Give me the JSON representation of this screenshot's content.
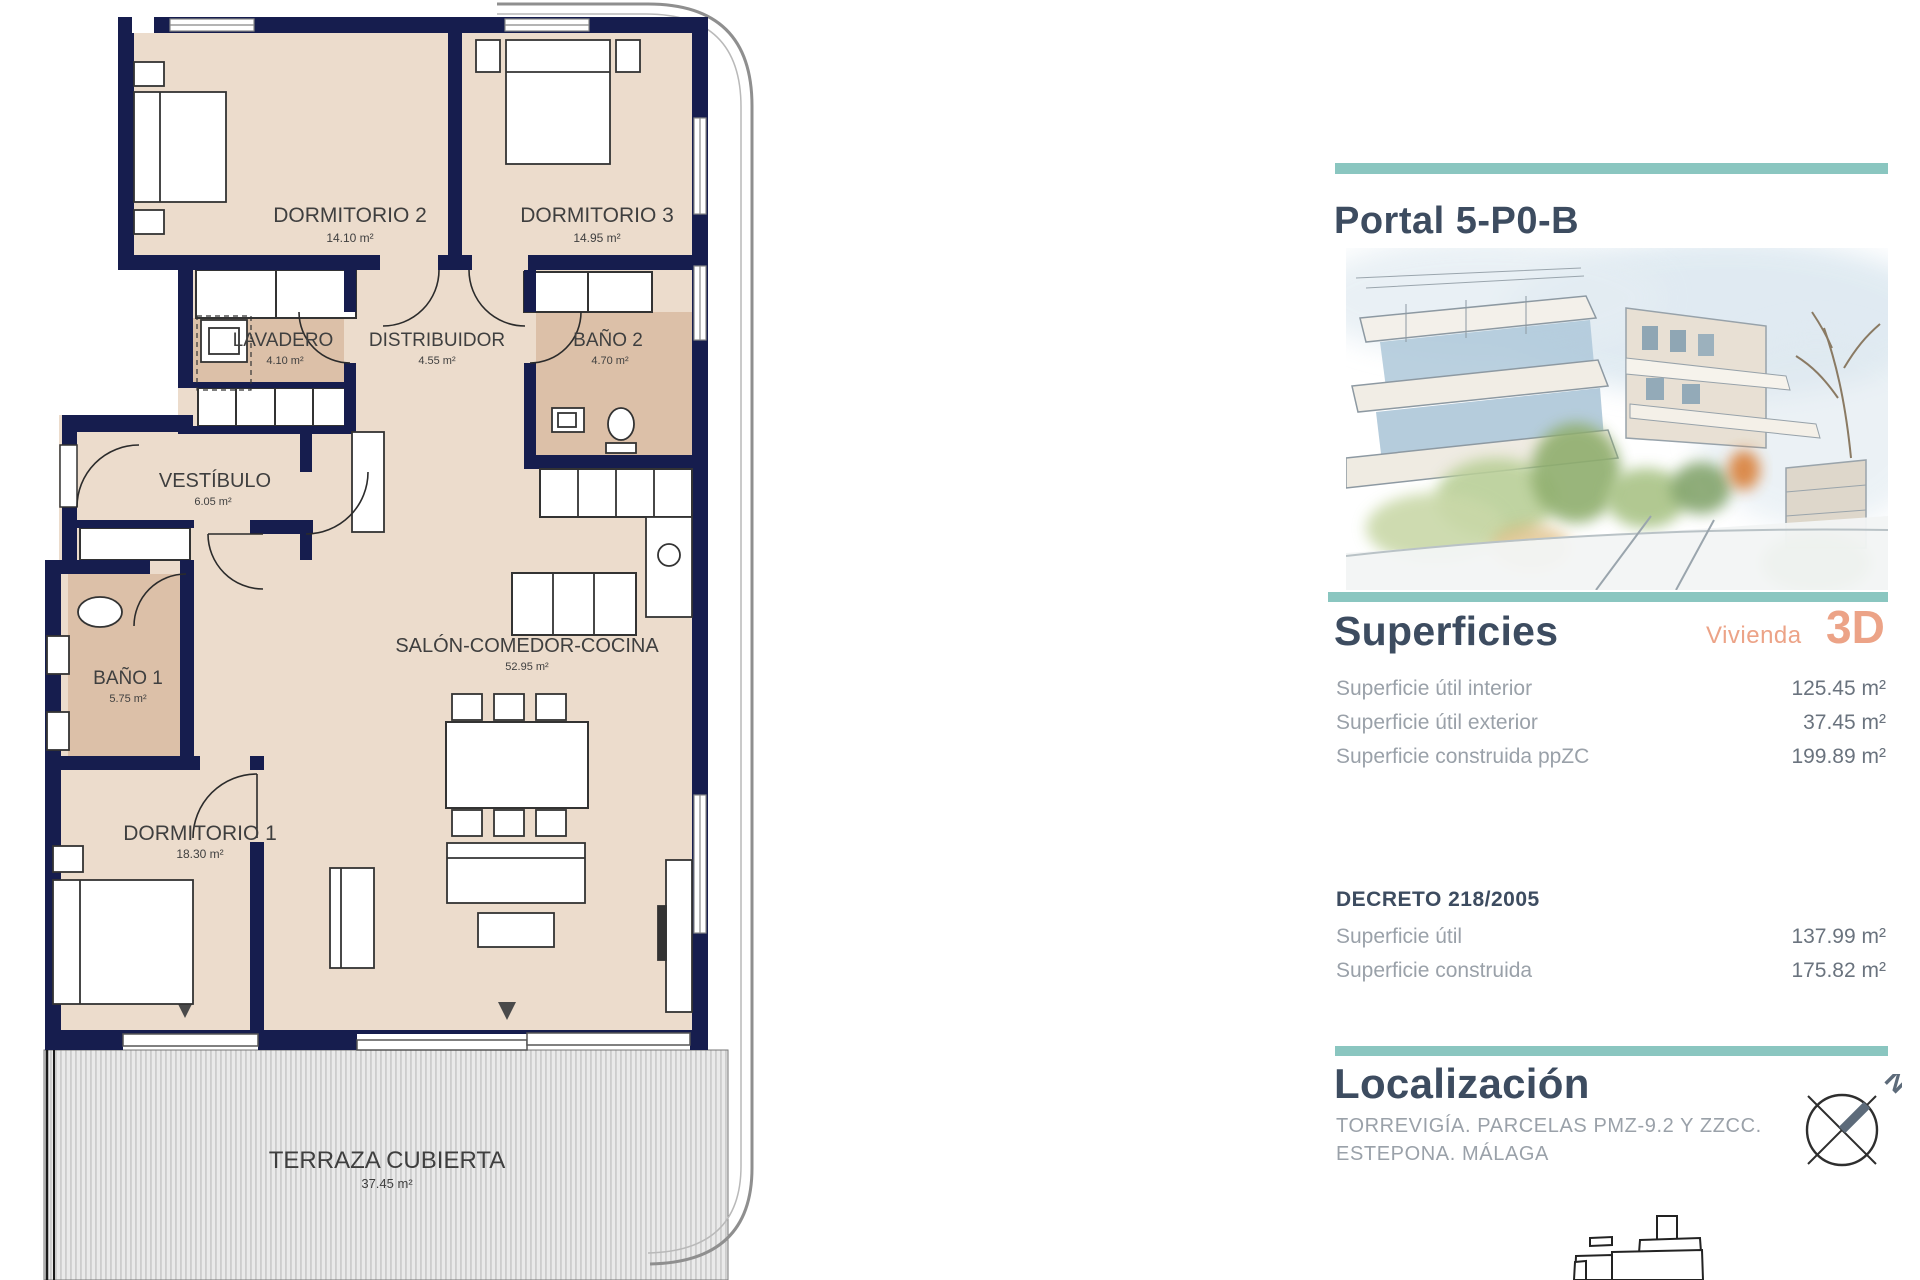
{
  "colors": {
    "wall_navy": "#161d4e",
    "floor_beige": "#ecdccc",
    "wet_tan": "#dcc0a8",
    "accent_teal": "#8ac6c0",
    "heading_slate": "#3d4c60",
    "accent_salmon": "#eca387",
    "label_gray": "#9aa1a9",
    "value_gray": "#6a737e"
  },
  "floor_plan": {
    "rooms": [
      {
        "name": "DORMITORIO 2",
        "area": "14.10 m²"
      },
      {
        "name": "DORMITORIO 3",
        "area": "14.95 m²"
      },
      {
        "name": "LAVADERO",
        "area": "4.10 m²"
      },
      {
        "name": "DISTRIBUIDOR",
        "area": "4.55 m²"
      },
      {
        "name": "BAÑO 2",
        "area": "4.70 m²"
      },
      {
        "name": "VESTÍBULO",
        "area": "6.05 m²"
      },
      {
        "name": "BAÑO 1",
        "area": "5.75 m²"
      },
      {
        "name": "SALÓN-COMEDOR-COCINA",
        "area": "52.95 m²"
      },
      {
        "name": "DORMITORIO 1",
        "area": "18.30 m²"
      },
      {
        "name": "TERRAZA CUBIERTA",
        "area": "37.45 m²"
      }
    ]
  },
  "panel": {
    "title": "Portal 5-P0-B",
    "superficies": {
      "heading": "Superficies",
      "vivienda_label": "Vivienda",
      "vivienda_value": "3D",
      "rows": [
        {
          "label": "Superficie útil interior",
          "value": "125.45 m²"
        },
        {
          "label": "Superficie útil exterior",
          "value": "37.45 m²"
        },
        {
          "label": "Superficie construida ppZC",
          "value": "199.89 m²"
        }
      ]
    },
    "decreto": {
      "heading": "DECRETO 218/2005",
      "rows": [
        {
          "label": "Superficie útil",
          "value": "137.99 m²"
        },
        {
          "label": "Superficie construida",
          "value": "175.82 m²"
        }
      ]
    },
    "localizacion": {
      "heading": "Localización",
      "address_line1": "TORREVIGÍA. PARCELAS PMZ-9.2 Y ZZCC.",
      "address_line2": "ESTEPONA. MÁLAGA"
    },
    "compass": {
      "north_label": "N"
    }
  }
}
